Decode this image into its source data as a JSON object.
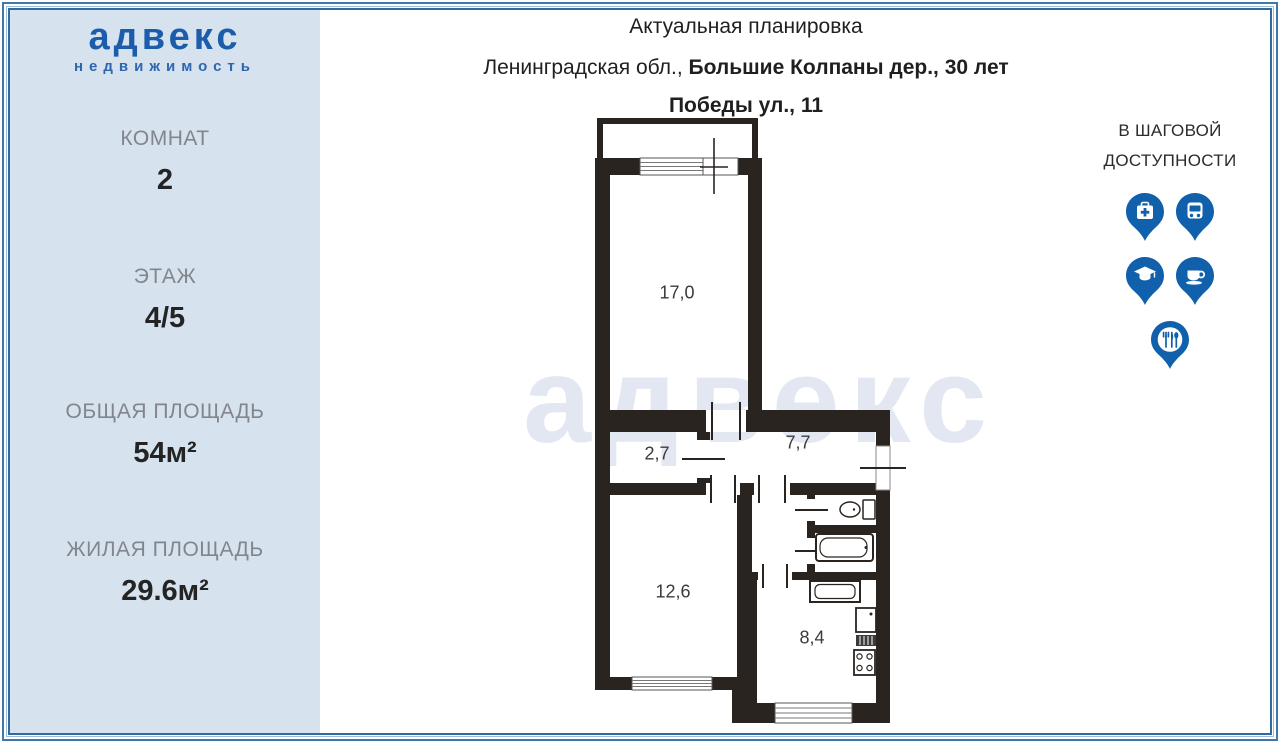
{
  "logo": {
    "brand": "адвекс",
    "tagline": "недвижимость"
  },
  "sidebar": {
    "stats": [
      {
        "label": "КОМНАТ",
        "value": "2"
      },
      {
        "label": "ЭТАЖ",
        "value": "4/5"
      },
      {
        "label": "ОБЩАЯ ПЛОЩАДЬ",
        "value": "54м²"
      },
      {
        "label": "ЖИЛАЯ ПЛОЩАДЬ",
        "value": "29.6м²"
      }
    ]
  },
  "header": {
    "title": "Актуальная планировка",
    "address_regular": "Ленинградская обл., ",
    "address_bold_line1": "Большие Колпаны дер., 30 лет",
    "address_bold_line2": "Победы ул., 11"
  },
  "floor_plan": {
    "watermark": "адвекс",
    "rooms": [
      {
        "area": "17,0"
      },
      {
        "area": "2,7"
      },
      {
        "area": "7,7"
      },
      {
        "area": "12,6"
      },
      {
        "area": "8,4"
      }
    ]
  },
  "walkable": {
    "line1": "В ШАГОВОЙ",
    "line2": "ДОСТУПНОСТИ",
    "pins": [
      {
        "icon": "medical-pin-icon"
      },
      {
        "icon": "bus-pin-icon"
      },
      {
        "icon": "education-pin-icon"
      },
      {
        "icon": "cafe-pin-icon"
      },
      {
        "icon": "restaurant-pin-icon"
      }
    ]
  },
  "colors": {
    "brand_blue": "#1b5cab",
    "pin_blue": "#1160ab",
    "sidebar_bg": "#d6e2ee",
    "wall": "#2a2421",
    "label_gray": "#82868c",
    "value_dark": "#242424",
    "frame_blue": "#3f78ad",
    "watermark_blue": "#e2e7f1",
    "text_dark": "#1f1f1f"
  }
}
